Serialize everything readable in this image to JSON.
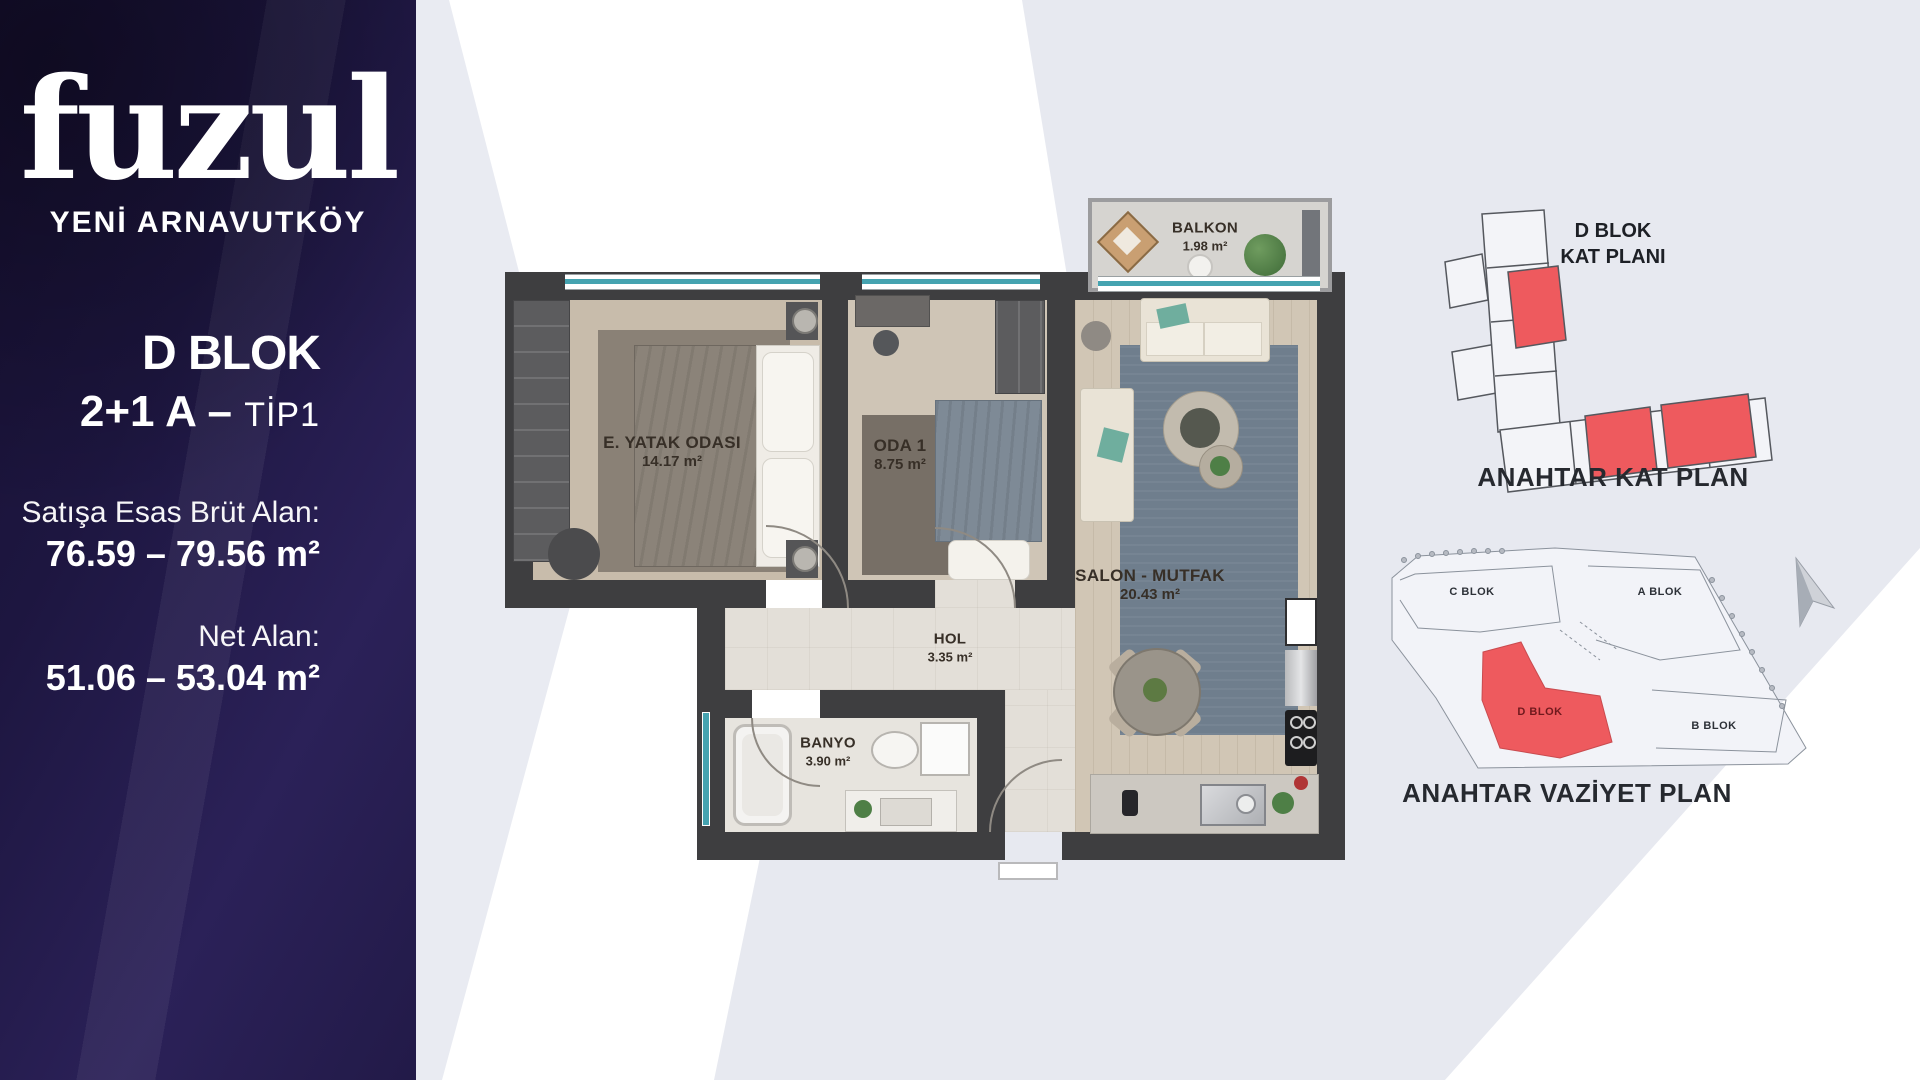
{
  "brand": {
    "logo": "fuzul",
    "project": "YENİ ARNAVUTKÖY"
  },
  "unit": {
    "block": "D BLOK",
    "type_main": "2+1 A –",
    "type_sub": "TİP1",
    "gross_label": "Satışa Esas Brüt Alan:",
    "gross_value": "76.59 – 79.56 m²",
    "net_label": "Net Alan:",
    "net_value": "51.06 – 53.04 m²"
  },
  "floorplan": {
    "rooms": [
      {
        "name": "BALKON",
        "area": "1.98 m²"
      },
      {
        "name": "E. YATAK ODASI",
        "area": "14.17 m²"
      },
      {
        "name": "ODA 1",
        "area": "8.75 m²"
      },
      {
        "name": "SALON - MUTFAK",
        "area": "20.43 m²"
      },
      {
        "name": "HOL",
        "area": "3.35 m²"
      },
      {
        "name": "BANYO",
        "area": "3.90 m²"
      }
    ]
  },
  "key_plans": {
    "kat_title_line1": "D BLOK",
    "kat_title_line2": "KAT PLANI",
    "kat_caption": "ANAHTAR KAT PLAN",
    "vaziyet_caption": "ANAHTAR VAZİYET PLAN",
    "site_blocks": [
      "C BLOK",
      "A BLOK",
      "B BLOK",
      "D BLOK"
    ]
  },
  "colors": {
    "accent_red": "#ee5a5e",
    "window_teal": "#45a3b0",
    "wall": "#3e3e40",
    "sidebar_bg": "#221a48"
  }
}
